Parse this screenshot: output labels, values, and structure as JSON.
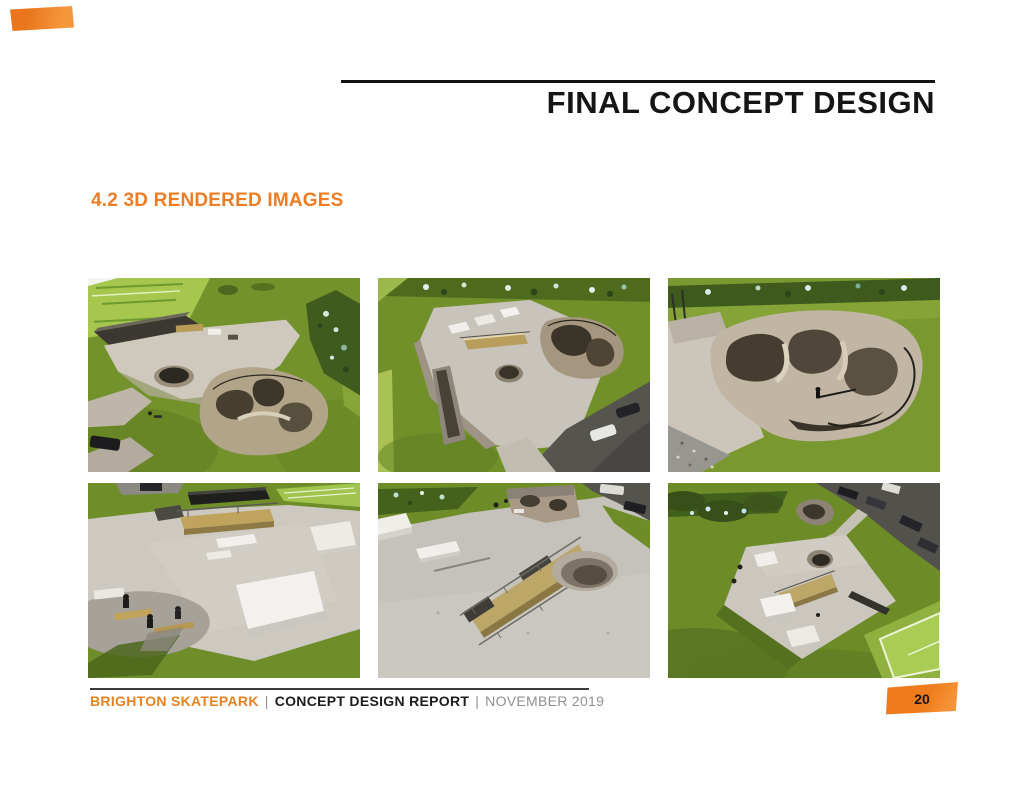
{
  "header": {
    "title": "FINAL CONCEPT DESIGN"
  },
  "section": {
    "heading": "4.2 3D RENDERED IMAGES"
  },
  "gallery": {
    "items": [
      {
        "alt": "3D render - aerial view of skate plaza and bowl complex beside tennis courts and creek"
      },
      {
        "alt": "3D render - aerial view of skate plaza with ramps, grind box, bowl and adjacent car park"
      },
      {
        "alt": "3D render - close-up of flow bowl complex set into grass embankment"
      },
      {
        "alt": "3D render - ground level view of street plaza with grind box, ledges, wedges and seating area"
      },
      {
        "alt": "3D render - close aerial of long grind ledge with rails and bowl depression on plaza"
      },
      {
        "alt": "3D render - high aerial of full skatepark site with courts, car park and landscaping"
      }
    ]
  },
  "footer": {
    "project": "BRIGHTON SKATEPARK",
    "separator": "|",
    "report": "CONCEPT DESIGN REPORT",
    "date": "NOVEMBER 2019",
    "page_number": "20"
  },
  "colors": {
    "accent_orange": "#EE7C1D",
    "heading_black": "#151515",
    "footer_gray": "#8E9191"
  }
}
